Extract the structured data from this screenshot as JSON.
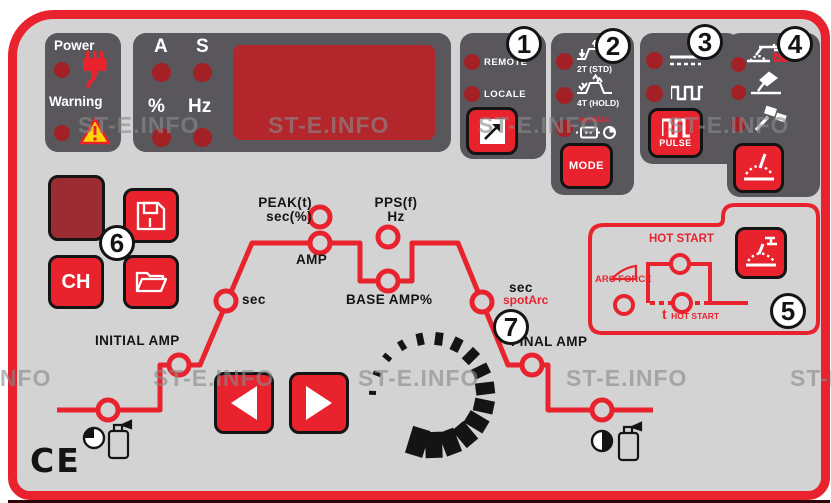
{
  "watermark": "ST-E.INFO",
  "status_panel": {
    "power_label": "Power",
    "warning_label": "Warning"
  },
  "display_panel": {
    "unit_a": "A",
    "unit_s": "S",
    "unit_percent": "%",
    "unit_hz": "Hz"
  },
  "control_source": {
    "remote_label": "REMOTE",
    "local_label": "LOCALE"
  },
  "trigger_panel": {
    "mode_2t": "2T (STD)",
    "mode_4t": "4T (HOLD)",
    "spot_arc": "spotArc",
    "mode_button": "MODE"
  },
  "pulse_panel": {
    "pulse_button": "PULSE"
  },
  "mma_panel": {
    "hot_start": "HOT START",
    "arc_force": "ARC FORCE",
    "t_prefix": "t",
    "t_hot_start": "HOT START"
  },
  "memory_panel": {
    "channel_button": "CH"
  },
  "cycle_diagram": {
    "peak_line1": "PEAK(t)",
    "peak_line2": "sec(%)",
    "amp": "AMP",
    "upslope_sec": "sec",
    "initial_amp": "INITIAL AMP",
    "pps_line1": "PPS(f)",
    "pps_line2": "Hz",
    "base_amp": "BASE AMP%",
    "downslope_sec": "sec",
    "spot_arc": "spotArc",
    "final_amp": "FINAL AMP"
  },
  "callouts": [
    "1",
    "2",
    "3",
    "4",
    "5",
    "6",
    "7"
  ],
  "ce_mark": "CE",
  "colors": {
    "accent_red": "#E8232E",
    "box_gray": "#59575C",
    "panel_gray": "#D3D3D4",
    "led_red": "#A32025",
    "screen_red": "#B2262C",
    "channel_maroon": "#9B2C31",
    "warning_yellow": "#FFD400"
  }
}
